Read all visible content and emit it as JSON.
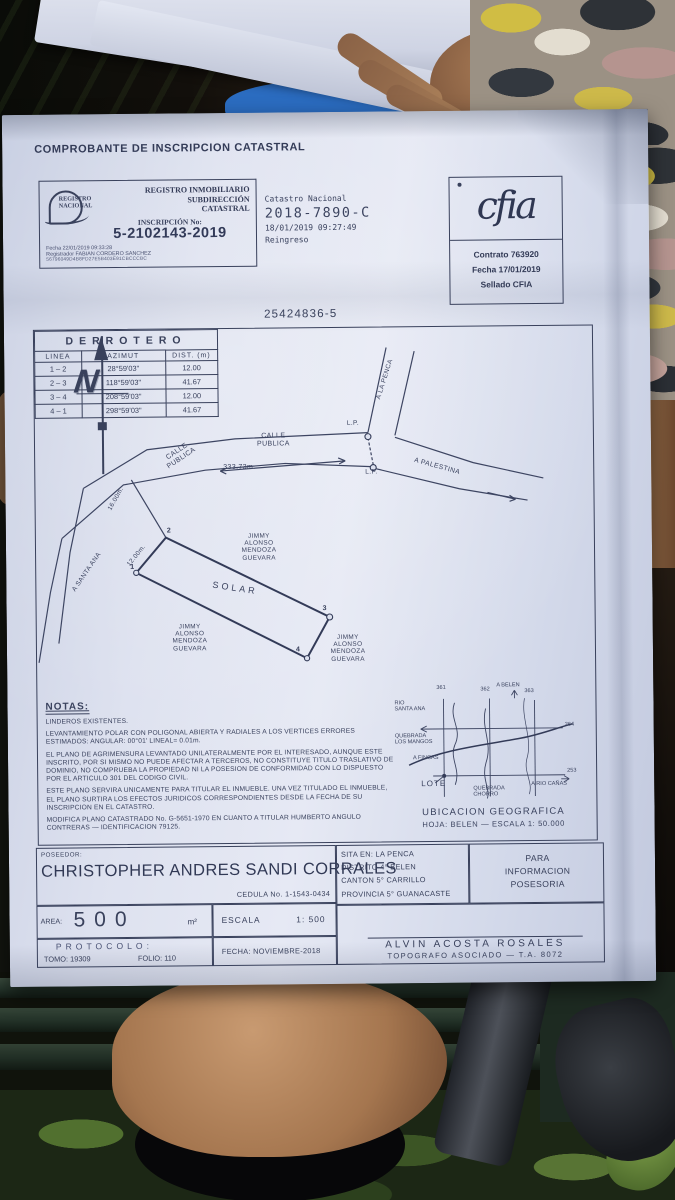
{
  "colors": {
    "paper": "#dde1ef",
    "ink": "#39415c"
  },
  "title": "COMPROBANTE DE INSCRIPCION CATASTRAL",
  "registro_box": {
    "logo_text": "REGISTRO\nNACIONAL",
    "header": "REGISTRO INMOBILIARIO\nSUBDIRECCIÓN\nCATASTRAL",
    "inscripcion_label": "INSCRIPCIÓN No:",
    "inscripcion_no": "5-2102143-2019",
    "meta": "Fecha        22/01/2019 09:33:28\nRegistrador  FABIAN CORDERO SANCHEZ",
    "hash": "56796049D4B8FD27E5B403E91CBCCCBC"
  },
  "catastro": {
    "line1": "Catastro Nacional",
    "line2": "2018-7890-C",
    "line3": "18/01/2019 09:27:49",
    "line4": "Reingreso"
  },
  "cfia_box": {
    "logo": "cfia",
    "lines": "Contrato 763920\nFecha 17/01/2019\nSellado CFIA"
  },
  "plan_number": "25424836-5",
  "derrotero": {
    "title": "DERROTERO",
    "headers": [
      "LINEA",
      "AZIMUT",
      "DIST. (m)"
    ],
    "rows": [
      [
        "1 – 2",
        "28°59'03\"",
        "12.00"
      ],
      [
        "2 – 3",
        "118°59'03\"",
        "41.67"
      ],
      [
        "3 – 4",
        "208°59'03\"",
        "12.00"
      ],
      [
        "4 – 1",
        "298°59'03\"",
        "41.67"
      ]
    ]
  },
  "plan": {
    "north_letter": "N",
    "calle_publica_rotated": "CALLE\nPUBLICA",
    "calle_publica_center": "CALLE\nPUBLICA",
    "road_distance": "333.73m.",
    "lp1": "L.P.",
    "lp2": "L.P.",
    "a_la_penca": "A LA PENCA",
    "a_palestina": "A PALESTINA",
    "a_santa_ana": "A SANTA ANA",
    "dim_16": "16.00m.",
    "dim_12": "12.00m.",
    "solar": "SOLAR",
    "corners": {
      "c1": "1",
      "c2": "2",
      "c3": "3",
      "c4": "4"
    },
    "neighbor_top": "JIMMY\nALONSO\nMENDOZA\nGUEVARA",
    "neighbor_left": "JIMMY\nALONSO\nMENDOZA\nGUEVARA",
    "neighbor_right": "JIMMY\nALONSO\nMENDOZA\nGUEVARA"
  },
  "notas": {
    "title": "NOTAS:",
    "p1": "LINDEROS EXISTENTES.",
    "p2": "LEVANTAMIENTO POLAR CON POLIGONAL ABIERTA Y RADIALES A LOS VERTICES ERRORES ESTIMADOS: ANGULAR: 00°01'    LINEAL= 0.01m.",
    "p3": "EL PLANO DE AGRIMENSURA LEVANTADO UNILATERALMENTE POR EL INTERESADO, AUNQUE ESTE INSCRITO, POR SI MISMO NO PUEDE AFECTAR A TERCEROS, NO CONSTITUYE TITULO TRASLATIVO DE DOMINIO, NO COMPRUEBA LA PROPIEDAD NI LA POSESION DE CONFORMIDAD CON LO DISPUESTO POR EL ARTICULO 301 DEL CODIGO CIVIL.",
    "p4": "ESTE PLANO SERVIRA UNICAMENTE PARA TITULAR EL INMUEBLE. UNA VEZ TITULADO EL INMUEBLE, EL PLANO  SURTIRA LOS EFECTOS JURIDICOS CORRESPONDIENTES DESDE LA FECHA DE SU INSCRIPCION  EN EL CATASTRO.",
    "p5": "MODIFICA PLANO CATASTRADO No. G-5651-1970 EN CUANTO A TITULAR HUMBERTO ANGULO CONTRERAS — IDENTIFICACION 79125."
  },
  "map": {
    "grid_x1": "361",
    "grid_x2": "362",
    "grid_x3": "363",
    "grid_y1": "264",
    "grid_y2": "253",
    "rio_santa_ana": "RIO\nSANTA ANA",
    "a_belen": "A BELEN",
    "quebrada_mangos": "QUEBRADA\nLOS MANGOS",
    "a_fincas": "A FINCAS",
    "lote": "LOTE",
    "quebrada_chorro": "QUEBRADA\nCHORRO",
    "a_rio_canas": "A RIO CAÑAS",
    "title": "UBICACION GEOGRAFICA",
    "subtitle": "HOJA: BELEN — ESCALA 1: 50.000"
  },
  "footer": {
    "poseedor_label": "POSEEDOR:",
    "poseedor_name": "CHRISTOPHER ANDRES SANDI CORRALES",
    "cedula": "CEDULA No. 1-1543-0434",
    "area_label": "AREA:",
    "area_value": "500",
    "area_unit": "m²",
    "escala_label": "ESCALA",
    "escala_value": "1: 500",
    "protocolo_label": "PROTOCOLO:",
    "tomo": "TOMO: 19309",
    "folio": "FOLIO: 110",
    "fecha": "FECHA: NOVIEMBRE-2018",
    "sita": "SITA EN: LA PENCA",
    "distrito": "DISTRITO  4° BELEN",
    "canton": "CANTON  5° CARRILLO",
    "provincia": "PROVINCIA 5° GUANACASTE",
    "para_info": "PARA\nINFORMACION\nPOSESORIA",
    "topografo_name": "ALVIN ACOSTA ROSALES",
    "topografo_title": "TOPOGRAFO ASOCIADO — T.A. 8072"
  }
}
